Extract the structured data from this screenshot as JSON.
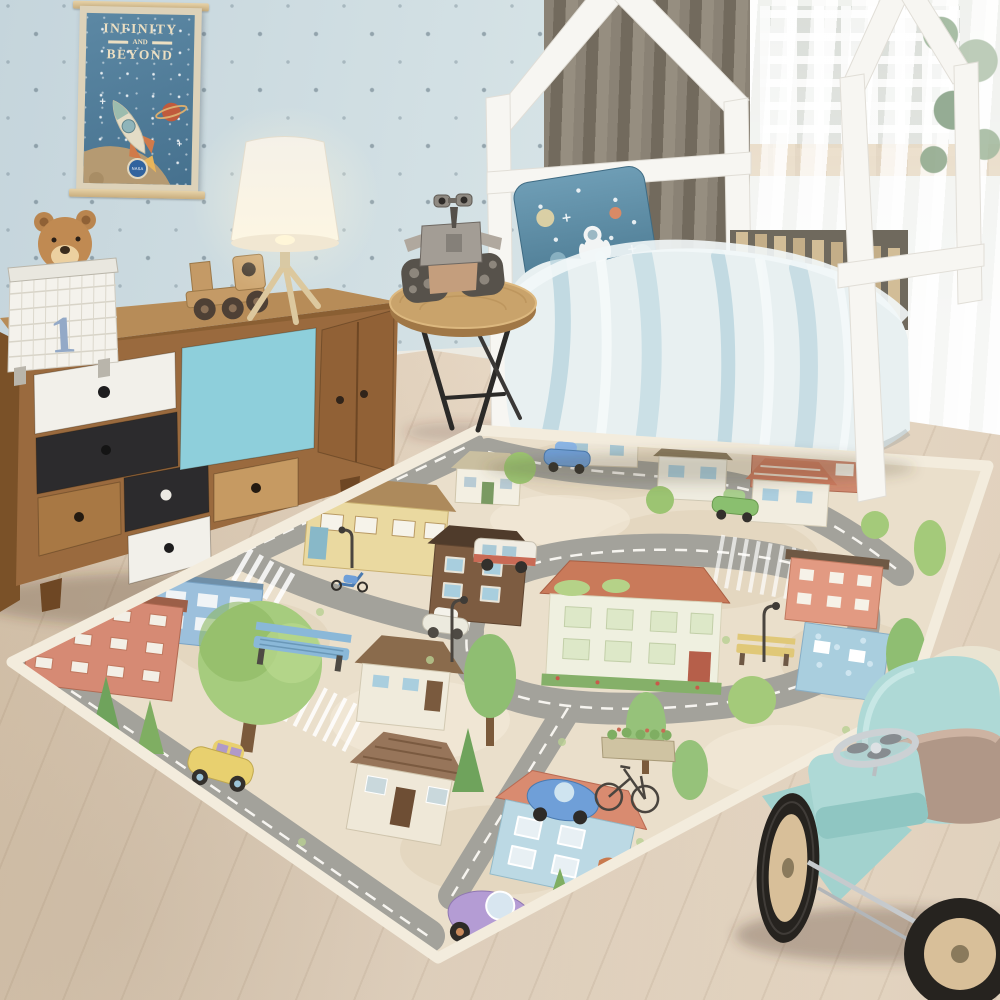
{
  "scene": {
    "setting": "children's bedroom product photo",
    "subject": "city road play rug"
  },
  "poster": {
    "line1": "INFINITY",
    "line2": "AND",
    "line3": "BEYOND",
    "badge": "NASA"
  },
  "basket": {
    "number": "1"
  },
  "palette": {
    "wall": "#ccdce2",
    "floor": "#e0d0bc",
    "curtain": "#847c6f",
    "dresser_wood": "#9a6a3e",
    "drawer_blue": "#8ecfdb",
    "drawer_black": "#2c2b2d",
    "drawer_white": "#f2f0ea",
    "bed_frame": "#f7f6f2",
    "bedding": "#e8f0f1",
    "bedding_stripe": "#a9cdd9",
    "pillow": "#5e8fa8",
    "rug_base": "#eadfcb",
    "rug_road": "#a3a29b",
    "rug_border": "#f3ecdd",
    "ride_on_car": "#aed9d6",
    "lamp_shade": "#f9f5ec",
    "poster_blue": "#4f7c9b",
    "teddy": "#c08a52"
  },
  "objects": [
    "polka-dot-wall",
    "space-poster",
    "wire-basket-with-teddy",
    "wooden-sideboard",
    "toy-truck",
    "tripod-table-lamp",
    "round-side-table",
    "robot-toy",
    "house-frame-bed",
    "astronaut-pillow",
    "watercolor-duvet",
    "gray-curtain",
    "window-with-sheer-curtains",
    "potted-plant",
    "city-play-rug",
    "ride-on-toy-car",
    "wood-floor"
  ]
}
